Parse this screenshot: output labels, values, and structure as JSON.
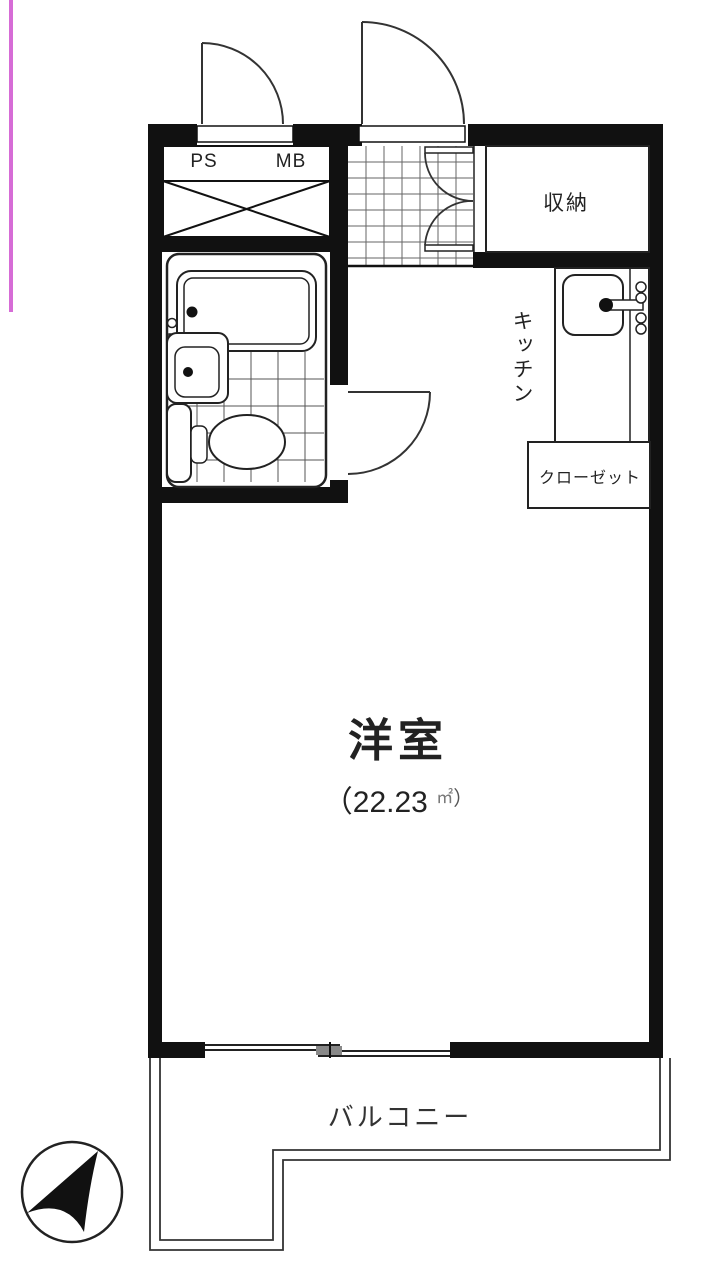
{
  "plan": {
    "labels": {
      "ps": "PS",
      "mb": "MB",
      "storage": "収納",
      "kitchen": "キッチン",
      "closet": "クローゼット",
      "main_room": "洋室",
      "area_open": "（",
      "area_value": "22.23",
      "area_unit": "㎡",
      "area_close": "）",
      "balcony": "バルコニー"
    },
    "colors": {
      "wall": "#111111",
      "thin_line": "#222222",
      "arc_line": "#333333",
      "tile_grid": "#666666",
      "window_overlap": "#888888",
      "artifact_pink": "#cf52cf"
    },
    "icons": {
      "compass": "north-arrow-compass-icon"
    }
  }
}
